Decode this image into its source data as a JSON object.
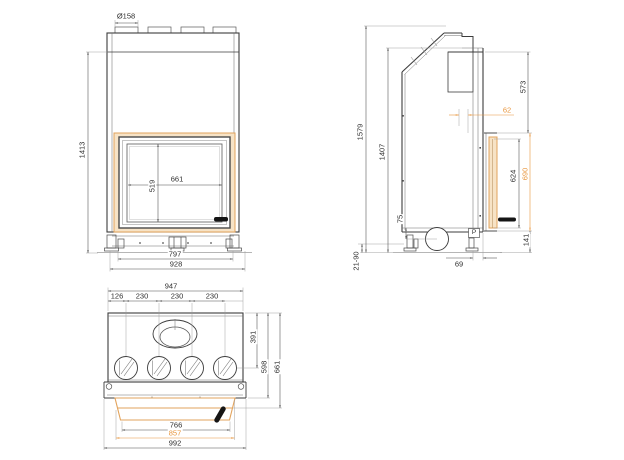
{
  "drawing": {
    "kind": "fireplace-insert-technical-drawing",
    "colors": {
      "accent_orange": "#E8953C",
      "frame_fill": "#F7E3C6",
      "frame_stroke": "#E2A35C",
      "line": "#3c3c3c"
    },
    "views": {
      "front": {
        "dims": {
          "flue_diameter": "Ø158",
          "overall_height": "1413",
          "glass_width": "661",
          "glass_height": "519",
          "base_width": "797",
          "body_width": "928"
        }
      },
      "side": {
        "dims": {
          "overall_height": "1579",
          "casing_height": "1407",
          "top_to_door": "573",
          "door_offset": "62",
          "glass_height": "624",
          "door_height": "690",
          "plinth_height": "141",
          "intake_offset": "75",
          "leveling_range": "21-90",
          "front_clearance": "69",
          "marker": "P"
        }
      },
      "top": {
        "dims": {
          "casing_width": "947",
          "outlet_offset": "126",
          "outlet_pitch_1": "230",
          "outlet_pitch_2": "230",
          "outlet_pitch_3": "230",
          "flue_center_depth": "391",
          "casing_depth": "598",
          "overall_depth": "661",
          "glass_width": "766",
          "door_width": "857",
          "overall_width": "992"
        }
      }
    }
  }
}
